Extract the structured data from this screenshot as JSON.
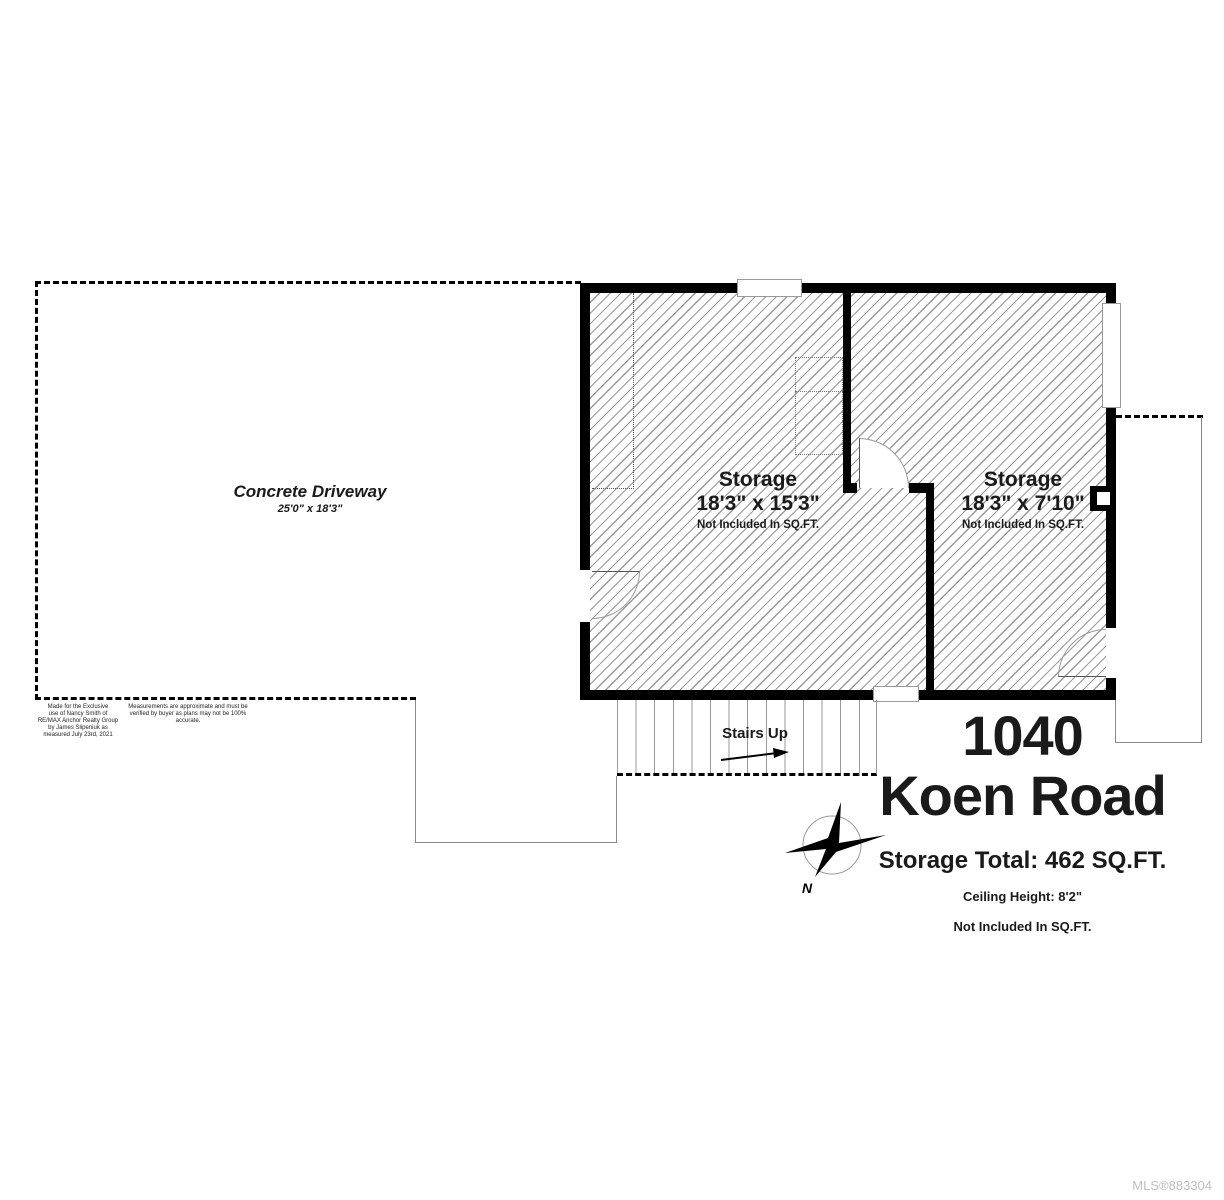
{
  "plan": {
    "driveway": {
      "label": "Concrete Driveway",
      "dimensions": "25'0\" x 18'3\""
    },
    "rooms": [
      {
        "name": "Storage",
        "dimensions": "18'3\" x 15'3\"",
        "note": "Not Included In SQ.FT."
      },
      {
        "name": "Storage",
        "dimensions": "18'3\" x 7'10\"",
        "note": "Not Included In SQ.FT."
      }
    ],
    "stairs": {
      "label": "Stairs Up"
    },
    "compass": {
      "north_label": "N"
    }
  },
  "title_block": {
    "address_number": "1040",
    "address_street": "Koen Road",
    "storage_total": "Storage Total: 462 SQ.FT.",
    "ceiling_height": "Ceiling Height: 8'2\"",
    "note": "Not Included In SQ.FT."
  },
  "disclaimers": {
    "made_for_lines": [
      "Made for the Exclusive",
      "use of Nancy Smith of",
      "RE/MAX Anchor Realty Group",
      "by James Slipeniuk as",
      "measured July 23rd, 2021"
    ],
    "measurement_lines": [
      "Measurements are approximate and must be",
      "verified by buyer as plans may not be 100% accurate."
    ]
  },
  "footer": {
    "mls_number": "MLS®883304"
  },
  "colors": {
    "wall": "#000000",
    "hatch_line": "#999999",
    "dashed_outline": "#000000",
    "mls_text": "#c0c0c0"
  }
}
